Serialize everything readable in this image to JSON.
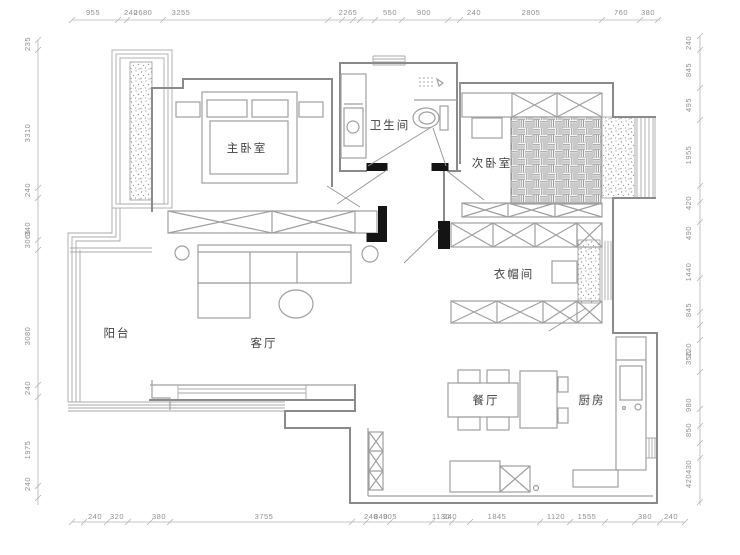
{
  "colors": {
    "background": "#ffffff",
    "wall_line": "#8a8a8a",
    "furniture_line": "#9f9f9f",
    "window_line": "#a8a8a8",
    "dim_line": "#b4b4b4",
    "dim_text": "#8f8f8f",
    "room_text": "#3f3f3f",
    "black_fill": "#141414"
  },
  "rooms": {
    "master_bedroom": "主卧室",
    "bathroom": "卫生间",
    "second_bedroom": "次卧室",
    "cloakroom": "衣帽间",
    "balcony": "阳台",
    "living_room": "客厅",
    "dining_room": "餐厅",
    "kitchen": "厨房"
  },
  "dims": {
    "top": [
      "955",
      "240",
      "2680",
      "3255",
      "2265",
      "550",
      "900",
      "240",
      "2805",
      "760",
      "380"
    ],
    "left": [
      "235",
      "3310",
      "240",
      "340",
      "3065",
      "3080",
      "240",
      "1975",
      "240"
    ],
    "right": [
      "240",
      "845",
      "495",
      "1955",
      "420",
      "490",
      "1440",
      "845",
      "220",
      "350",
      "980",
      "850",
      "430",
      "420"
    ],
    "bottom": [
      "240",
      "320",
      "380",
      "3755",
      "240",
      "840",
      "905",
      "1130",
      "240",
      "1845",
      "1120",
      "1555",
      "380",
      "240"
    ]
  }
}
